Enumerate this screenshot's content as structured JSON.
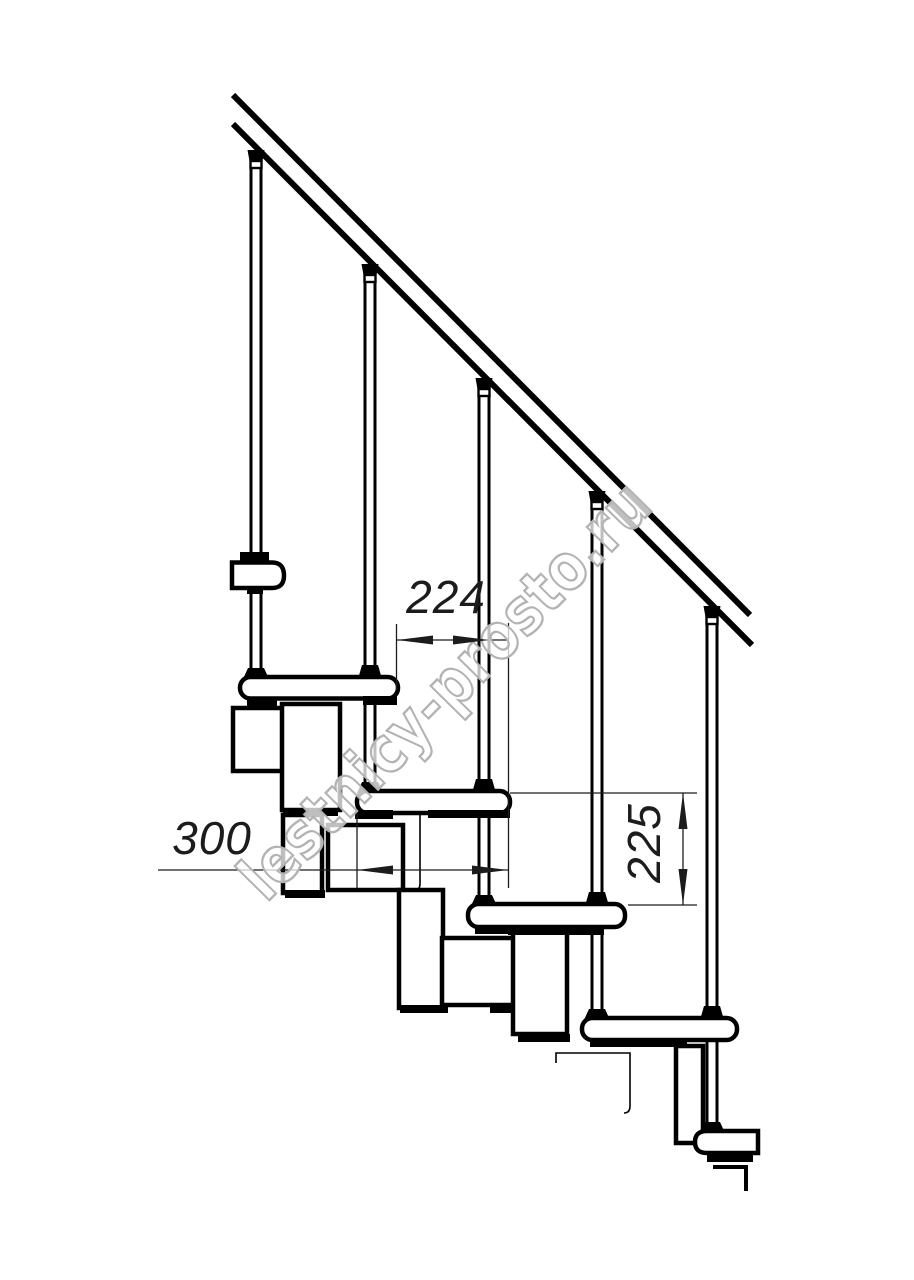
{
  "drawing": {
    "kind": "modular-staircase-side-view",
    "background": "#ffffff",
    "line_color": "#000000"
  },
  "dimensions": {
    "step_run": {
      "label": "224"
    },
    "tread_depth": {
      "label": "300"
    },
    "riser_height": {
      "label": "225"
    }
  },
  "watermark": {
    "text": "lestnicy-prosto.ru",
    "color": "#b3b3b3"
  }
}
